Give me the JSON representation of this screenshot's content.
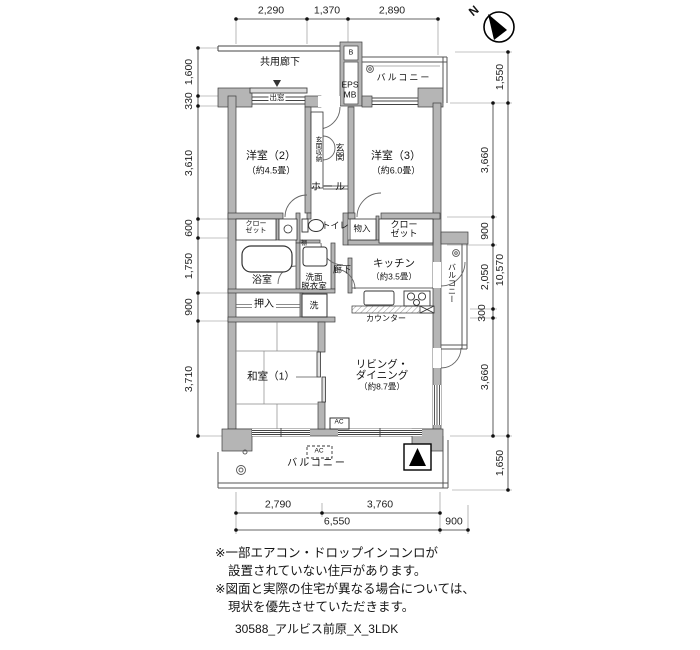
{
  "compass": {
    "north_label": "N"
  },
  "dims": {
    "top": [
      "2,290",
      "1,370",
      "2,890"
    ],
    "left": [
      "1,600",
      "330",
      "3,610",
      "600",
      "1,750",
      "900",
      "3,710"
    ],
    "right_inner": [
      "3,660",
      "900",
      "2,050",
      "300",
      "3,660"
    ],
    "right_outer": [
      "1,550",
      "10,570",
      "1,650"
    ],
    "bottom_upper": [
      "2,790",
      "3,760"
    ],
    "bottom_lower": [
      "6,550",
      "900"
    ]
  },
  "rooms": {
    "common_corridor": "共用廊下",
    "bay_window": "出窓",
    "eps_b": "B",
    "eps_line1": "EPS",
    "eps_line2": "MB",
    "balcony_top": "バルコニー",
    "western2": "洋室（2）",
    "western2_size": "（約4.5畳）",
    "western3": "洋室（3）",
    "western3_size": "（約6.0畳）",
    "entrance_storage": "玄関収納",
    "entrance": "玄関",
    "hall": "ホール",
    "closet_line1": "クロー",
    "closet_line2": "ゼット",
    "toilet": "トイレ",
    "storage": "物入",
    "bathroom": "浴室",
    "washroom_line1": "洗面",
    "washroom_line2": "脱衣室",
    "shelf": "棚",
    "corridor": "廊下",
    "kitchen": "キッチン",
    "kitchen_size": "（約3.5畳）",
    "balcony_right": "バルコニー",
    "oshiire": "押入",
    "washer": "洗",
    "counter": "カウンター",
    "japanese1": "和室（1）",
    "living_line1": "リビング・",
    "living_line2": "ダイニング",
    "living_size": "（約8.7畳）",
    "ac": "AC",
    "balcony_bottom": "バルコニー"
  },
  "notes": [
    "※一部エアコン・ドロップインコンロが",
    "設置されていない住戸があります。",
    "※図面と実際の住宅が異なる場合については、",
    "現状を優先させていただきます。"
  ],
  "footer": "30588_アルビス前原_X_3LDK"
}
